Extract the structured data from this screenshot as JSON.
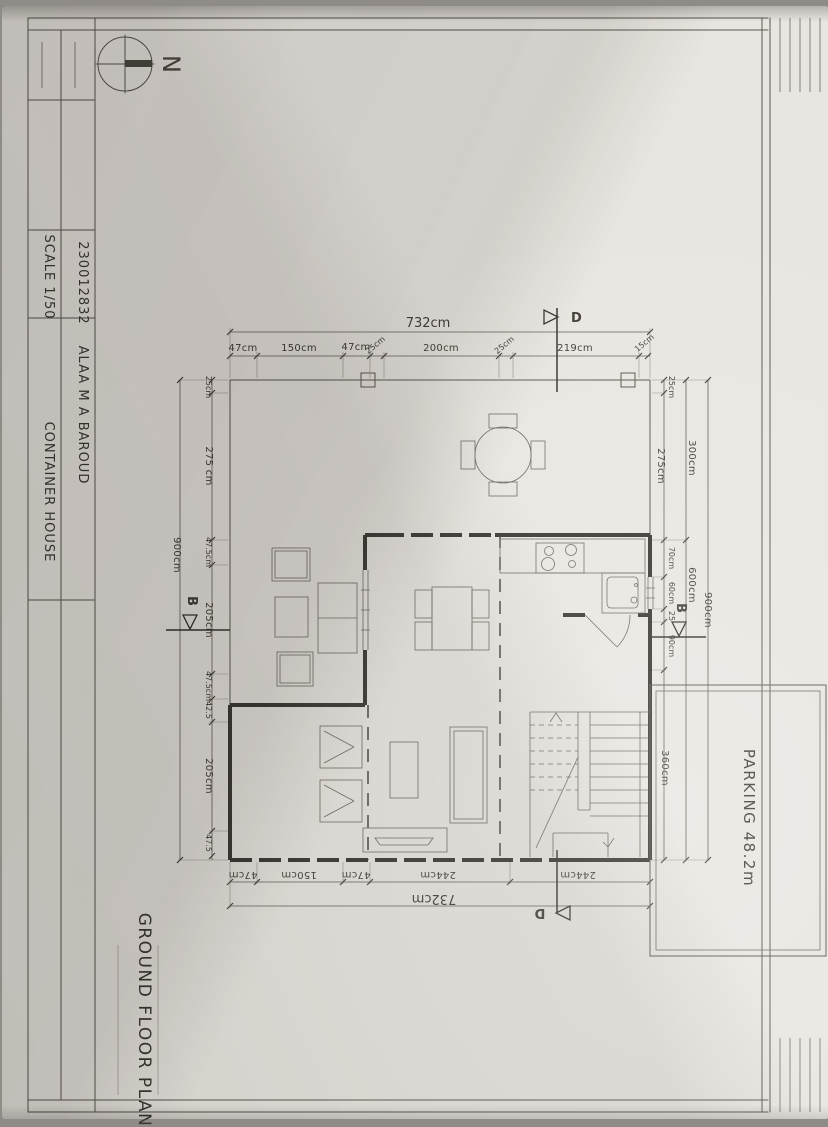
{
  "sheet": {
    "title_block": {
      "student_id": "230012832",
      "scale": "SCALE 1/50",
      "name": "ALAA M A BAROUD",
      "project": "CONTAINER HOUSE"
    },
    "compass": {
      "north": "N"
    },
    "drawing_title": "GROUND FLOOR PLAN"
  },
  "plan": {
    "dims": {
      "top_total": "732cm",
      "top_chain": [
        "47cm",
        "150cm",
        "47cm",
        "25cm",
        "200cm",
        "25cm",
        "219cm",
        "15cm"
      ],
      "bottom_chain": [
        "47cm",
        "150cm",
        "47cm",
        "244cm",
        "244cm"
      ],
      "bottom_total": "732cm",
      "left_chain": [
        "25cm",
        "275 cm",
        "47.5cm",
        "205cm",
        "47.5cm",
        "42.5",
        "205cm",
        "47.5"
      ],
      "left_total": "900cm",
      "right_inner_chain": [
        "25cm",
        "275cm",
        "70cm",
        "60cm",
        "25",
        "90cm"
      ],
      "right_mid_chain": [
        "300cm",
        "600cm"
      ],
      "right_total": "900cm",
      "parking_width": "360cm"
    },
    "sections": {
      "b": "B",
      "d": "D"
    },
    "parking_label": "PARKING 48.2m"
  },
  "colors": {
    "paper": "#e9e6e1",
    "pencil": "#5a564f",
    "wall": "#37342f"
  }
}
